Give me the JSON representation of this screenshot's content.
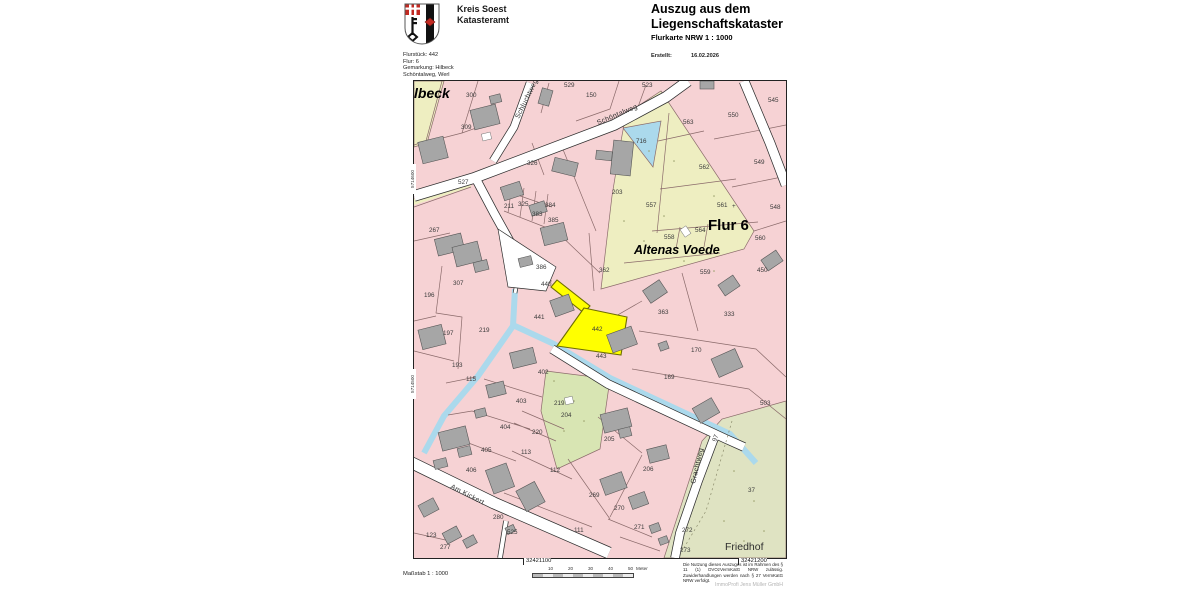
{
  "header": {
    "authority": {
      "line1": "Kreis Soest",
      "line2": "Katasteramt"
    },
    "coat_of_arms_icon": "kreis-soest-wappen",
    "doc_title_line1": "Auszug aus dem",
    "doc_title_line2": "Liegenschaftskataster",
    "doc_subtitle": "Flurkarte NRW 1 : 1000",
    "created_label": "Erstellt:",
    "created_value": "16.02.2026",
    "parcel_info_lines": [
      "Flurstück: 442",
      "Flur: 6",
      "Gemarkung: Hilbeck",
      "Schöntalweg, Werl"
    ]
  },
  "map": {
    "highlighted_parcel": "442",
    "colors": {
      "parcel": "#f6d2d4",
      "field": "#eeeec1",
      "garden": "#d8e5b3",
      "cemetery": "#dfe3c2",
      "water": "#abd9ec",
      "highlight": "#ffff00",
      "building": "#a6a6a6",
      "road": "#ffffff",
      "line": "#8a6a6a"
    },
    "area_labels": [
      {
        "text": "Hilbeck",
        "x": -14,
        "y": 17,
        "size": 14,
        "style": "bold-italic"
      },
      {
        "text": "Flur 6",
        "x": 294,
        "y": 149,
        "size": 15,
        "style": "bold"
      },
      {
        "text": "Altenas Voede",
        "x": 220,
        "y": 173,
        "size": 12.5,
        "style": "bold-italic"
      },
      {
        "text": "Friedhof",
        "x": 311,
        "y": 469,
        "size": 10.5,
        "style": "normal"
      }
    ],
    "street_labels": [
      {
        "text": "Schluchtweg",
        "x": 105,
        "y": 38,
        "rot": -64
      },
      {
        "text": "Schöntalweg",
        "x": 184,
        "y": 44,
        "rot": -23
      },
      {
        "text": "Am Kickert",
        "x": 36,
        "y": 407,
        "rot": 27
      },
      {
        "text": "Grachtweg",
        "x": 281,
        "y": 403,
        "rot": -77
      }
    ],
    "parcel_numbers": [
      {
        "n": "300",
        "x": 52,
        "y": 16
      },
      {
        "n": "309",
        "x": 47,
        "y": 48
      },
      {
        "n": "529",
        "x": 150,
        "y": 6
      },
      {
        "n": "150",
        "x": 172,
        "y": 16
      },
      {
        "n": "523",
        "x": 228,
        "y": 6
      },
      {
        "n": "545",
        "x": 354,
        "y": 21
      },
      {
        "n": "563",
        "x": 269,
        "y": 43
      },
      {
        "n": "716",
        "x": 222,
        "y": 62
      },
      {
        "n": "550",
        "x": 314,
        "y": 36
      },
      {
        "n": "562",
        "x": 285,
        "y": 88
      },
      {
        "n": "549",
        "x": 340,
        "y": 83
      },
      {
        "n": "326",
        "x": 113,
        "y": 84
      },
      {
        "n": "527",
        "x": 44,
        "y": 103
      },
      {
        "n": "203",
        "x": 198,
        "y": 113
      },
      {
        "n": "557",
        "x": 232,
        "y": 126
      },
      {
        "n": "561",
        "x": 303,
        "y": 126
      },
      {
        "n": "+",
        "x": 318,
        "y": 127
      },
      {
        "n": "548",
        "x": 356,
        "y": 128
      },
      {
        "n": "211",
        "x": 90,
        "y": 127
      },
      {
        "n": "325",
        "x": 104,
        "y": 125
      },
      {
        "n": "383",
        "x": 118,
        "y": 135
      },
      {
        "n": "384",
        "x": 131,
        "y": 126
      },
      {
        "n": "385",
        "x": 134,
        "y": 141
      },
      {
        "n": "267",
        "x": 15,
        "y": 151
      },
      {
        "n": "558",
        "x": 250,
        "y": 158
      },
      {
        "n": "564",
        "x": 281,
        "y": 151
      },
      {
        "n": "560",
        "x": 341,
        "y": 159
      },
      {
        "n": "559",
        "x": 286,
        "y": 193
      },
      {
        "n": "450",
        "x": 343,
        "y": 191
      },
      {
        "n": "386",
        "x": 122,
        "y": 188
      },
      {
        "n": "362",
        "x": 185,
        "y": 191
      },
      {
        "n": "307",
        "x": 39,
        "y": 204
      },
      {
        "n": "196",
        "x": 10,
        "y": 216
      },
      {
        "n": "440",
        "x": 127,
        "y": 205
      },
      {
        "n": "441",
        "x": 120,
        "y": 238
      },
      {
        "n": "442",
        "x": 178,
        "y": 250
      },
      {
        "n": "443",
        "x": 182,
        "y": 277
      },
      {
        "n": "363",
        "x": 244,
        "y": 233
      },
      {
        "n": "333",
        "x": 310,
        "y": 235
      },
      {
        "n": "197",
        "x": 29,
        "y": 254
      },
      {
        "n": "219",
        "x": 65,
        "y": 251
      },
      {
        "n": "170",
        "x": 277,
        "y": 271
      },
      {
        "n": "193",
        "x": 38,
        "y": 286
      },
      {
        "n": "115",
        "x": 52,
        "y": 300
      },
      {
        "n": "402",
        "x": 124,
        "y": 293
      },
      {
        "n": "169",
        "x": 250,
        "y": 298
      },
      {
        "n": "403",
        "x": 102,
        "y": 322
      },
      {
        "n": "219",
        "x": 140,
        "y": 324
      },
      {
        "n": "204",
        "x": 147,
        "y": 336
      },
      {
        "n": "503",
        "x": 346,
        "y": 324
      },
      {
        "n": "404",
        "x": 86,
        "y": 348
      },
      {
        "n": "220",
        "x": 118,
        "y": 353
      },
      {
        "n": "405",
        "x": 67,
        "y": 371
      },
      {
        "n": "113",
        "x": 107,
        "y": 373
      },
      {
        "n": "205",
        "x": 190,
        "y": 360
      },
      {
        "n": "112",
        "x": 136,
        "y": 391
      },
      {
        "n": "406",
        "x": 52,
        "y": 391
      },
      {
        "n": "269",
        "x": 175,
        "y": 416
      },
      {
        "n": "206",
        "x": 229,
        "y": 390
      },
      {
        "n": "111",
        "x": 160,
        "y": 451
      },
      {
        "n": "280",
        "x": 79,
        "y": 438
      },
      {
        "n": "525",
        "x": 93,
        "y": 453
      },
      {
        "n": "123",
        "x": 12,
        "y": 456
      },
      {
        "n": "277",
        "x": 26,
        "y": 468
      },
      {
        "n": "270",
        "x": 200,
        "y": 429
      },
      {
        "n": "271",
        "x": 220,
        "y": 448
      },
      {
        "n": "272",
        "x": 268,
        "y": 451
      },
      {
        "n": "273",
        "x": 266,
        "y": 471
      },
      {
        "n": "37",
        "x": 334,
        "y": 411
      },
      {
        "n": "97",
        "x": 302,
        "y": 361,
        "r": -70
      }
    ],
    "edge_coords": [
      {
        "text": "5714600",
        "y": 110
      },
      {
        "text": "5714500",
        "y": 315
      }
    ],
    "bottom_coords": [
      {
        "text": "32421100",
        "x": 112
      },
      {
        "text": "32421200",
        "x": 327
      }
    ]
  },
  "footer": {
    "scale_label": "Maßstab 1 : 1000",
    "scale_ticks": [
      "10",
      "20",
      "30",
      "40",
      "50"
    ],
    "scale_unit": "Meter",
    "legal_text": "Die Nutzung dieses Auszuges ist im Rahmen des § 11 (1) DVOzVermKatG NRW zulässig. Zuwiderhandlungen werden nach § 27 VermKatG NRW verfolgt.",
    "watermark": "ImmoProfi Jens Müller GmbH"
  }
}
